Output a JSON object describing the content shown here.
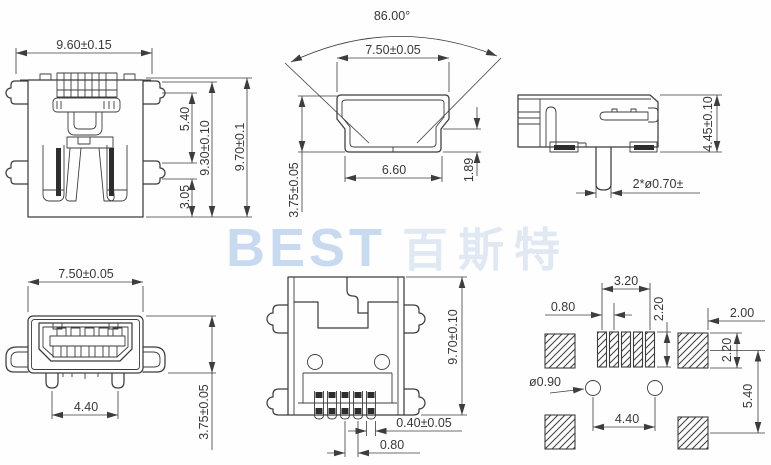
{
  "watermark": {
    "latin": "BEST",
    "cjk": "百斯特"
  },
  "colors": {
    "line": "#3d3d3d",
    "watermark_latin": "#c8daef",
    "watermark_cjk": "#dfe8f3",
    "background": "#fefefe"
  },
  "views": {
    "rear": {
      "width": "9.60±0.15",
      "upper_height": "5.40",
      "shell_height": "9.30±0.10",
      "total_height": "9.70±0.1",
      "lower_height": "3.05"
    },
    "mating": {
      "angle": "86.00°",
      "outer_width": "7.50±0.05",
      "inner_width": "6.60",
      "lip_height": "1.89",
      "height": "3.75±0.05"
    },
    "side": {
      "height": "4.45±0.10",
      "pegs": "2*ø0.70±"
    },
    "front": {
      "width": "7.50±0.05",
      "peg_span": "4.40",
      "height": "3.75±0.05"
    },
    "bottom": {
      "length": "9.70±0.10",
      "pin_width": "0.40±0.05",
      "pin_pitch": "0.80"
    },
    "pcb": {
      "pad_span": "3.20",
      "pad_pitch": "0.80",
      "pad_length": "2.20",
      "side_pad_width": "2.00",
      "side_pad_length": "2.20",
      "hole_diameter": "ø0.90",
      "hole_span": "4.40",
      "row_pitch": "5.40"
    }
  }
}
